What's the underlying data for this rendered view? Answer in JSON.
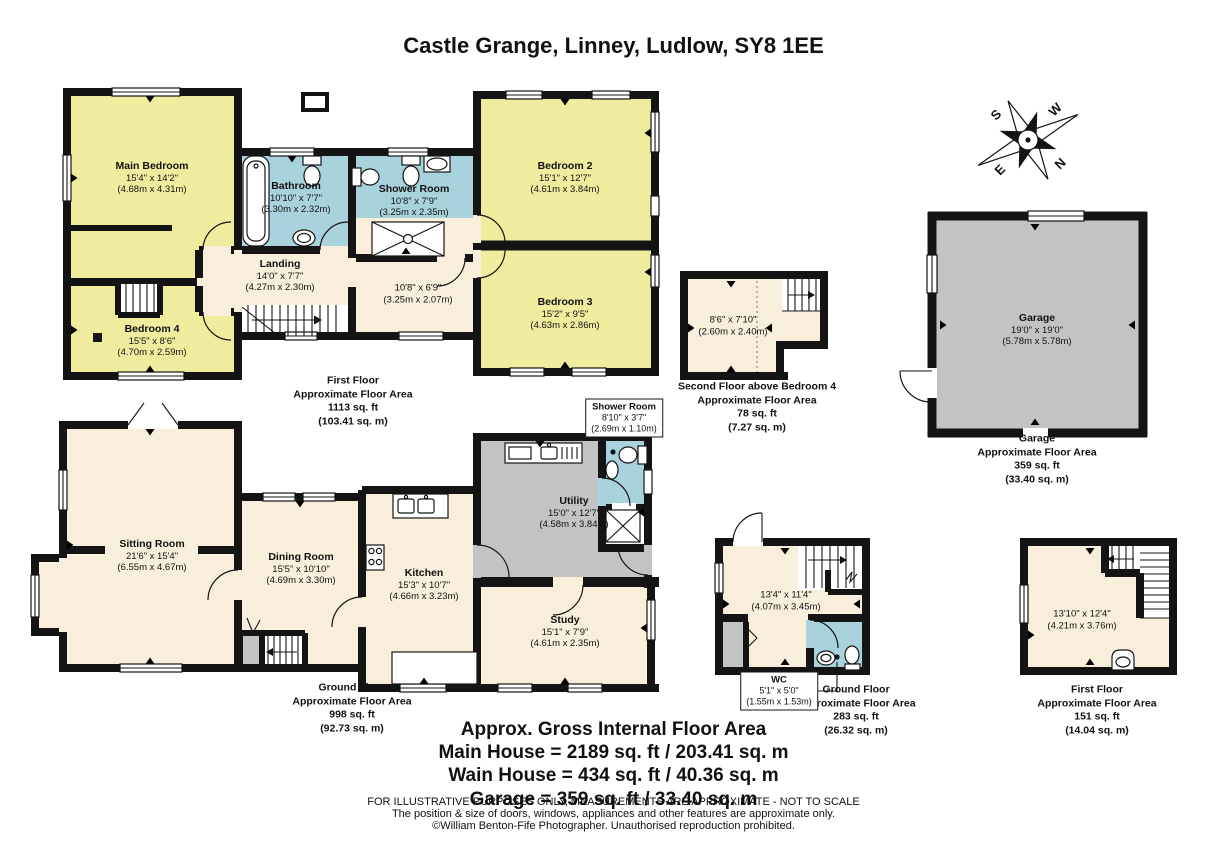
{
  "title": "Castle Grange, Linney, Ludlow, SY8 1EE",
  "compass": {
    "n": "N",
    "s": "S",
    "e": "E",
    "w": "W"
  },
  "first_floor": {
    "main_bedroom": {
      "name": "Main Bedroom",
      "imperial": "15'4\" x 14'2\"",
      "metric": "(4.68m x 4.31m)"
    },
    "bathroom": {
      "name": "Bathroom",
      "imperial": "10'10\" x 7'7\"",
      "metric": "(3.30m x 2.32m)"
    },
    "shower_room": {
      "name": "Shower Room",
      "imperial": "10'8\" x 7'9\"",
      "metric": "(3.25m x 2.35m)"
    },
    "bedroom_2": {
      "name": "Bedroom 2",
      "imperial": "15'1\" x 12'7\"",
      "metric": "(4.61m x 3.84m)"
    },
    "bedroom_3": {
      "name": "Bedroom 3",
      "imperial": "15'2\" x 9'5\"",
      "metric": "(4.63m x 2.86m)"
    },
    "bedroom_4": {
      "name": "Bedroom 4",
      "imperial": "15'5\" x 8'6\"",
      "metric": "(4.70m x 2.59m)"
    },
    "landing": {
      "name": "Landing",
      "imperial": "14'0\" x 7'7\"",
      "metric": "(4.27m x 2.30m)"
    },
    "inner_hall": {
      "imperial": "10'8\" x 6'9\"",
      "metric": "(3.25m x 2.07m)"
    },
    "area": [
      "First Floor",
      "Approximate Floor Area",
      "1113 sq. ft",
      "(103.41 sq. m)"
    ]
  },
  "second_floor": {
    "room": {
      "imperial": "8'6\" x 7'10\"",
      "metric": "(2.60m x 2.40m)"
    },
    "area": [
      "Second Floor above Bedroom 4",
      "Approximate Floor Area",
      "78 sq. ft",
      "(7.27 sq. m)"
    ]
  },
  "garage": {
    "room": {
      "name": "Garage",
      "imperial": "19'0\" x 19'0\"",
      "metric": "(5.78m x 5.78m)"
    },
    "area": [
      "Garage",
      "Approximate Floor Area",
      "359 sq. ft",
      "(33.40 sq. m)"
    ]
  },
  "ground_floor": {
    "sitting_room": {
      "name": "Sitting Room",
      "imperial": "21'6\" x 15'4\"",
      "metric": "(6.55m x 4.67m)"
    },
    "dining_room": {
      "name": "Dining Room",
      "imperial": "15'5\" x 10'10\"",
      "metric": "(4.69m x 3.30m)"
    },
    "kitchen": {
      "name": "Kitchen",
      "imperial": "15'3\" x 10'7\"",
      "metric": "(4.66m x 3.23m)"
    },
    "utility": {
      "name": "Utility",
      "imperial": "15'0\" x 12'7\"",
      "metric": "(4.58m x 3.84m)"
    },
    "shower_room": {
      "name": "Shower Room",
      "imperial": "8'10\" x 3'7\"",
      "metric": "(2.69m x 1.10m)"
    },
    "study": {
      "name": "Study",
      "imperial": "15'1\" x 7'9\"",
      "metric": "(4.61m x 2.35m)"
    },
    "area": [
      "Ground Floor",
      "Approximate Floor Area",
      "998 sq. ft",
      "(92.73 sq. m)"
    ]
  },
  "wain_house_ground": {
    "room": {
      "imperial": "13'4\" x 11'4\"",
      "metric": "(4.07m x 3.45m)"
    },
    "wc": {
      "name": "WC",
      "imperial": "5'1\" x 5'0\"",
      "metric": "(1.55m x 1.53m)"
    },
    "area": [
      "Ground Floor",
      "Approximate Floor Area",
      "283 sq. ft",
      "(26.32 sq. m)"
    ]
  },
  "wain_house_first": {
    "room": {
      "imperial": "13'10\" x 12'4\"",
      "metric": "(4.21m x 3.76m)"
    },
    "area": [
      "First Floor",
      "Approximate Floor Area",
      "151 sq. ft",
      "(14.04 sq. m)"
    ]
  },
  "summary": {
    "heading": "Approx. Gross Internal Floor Area",
    "main_house": "Main House = 2189 sq. ft / 203.41 sq. m",
    "wain_house": "Wain House = 434 sq. ft / 40.36 sq. m",
    "garage": "Garage = 359 sq. ft / 33.40 sq. m"
  },
  "disclaimer": [
    "FOR ILLUSTRATIVE PURPOSES ONLY, MEASUREMENTS ARE APPROXIMATE - NOT TO SCALE",
    "The position & size of doors, windows, appliances and other features are approximate only.",
    "©William Benton-Fife Photographer. Unauthorised reproduction prohibited."
  ],
  "colors": {
    "bedroom_yellow": "#f0ec9e",
    "hall_cream": "#f8eedb",
    "bath_blue": "#a9d3dc",
    "utility_gray": "#c3c3c3",
    "wall_black": "#141414"
  }
}
